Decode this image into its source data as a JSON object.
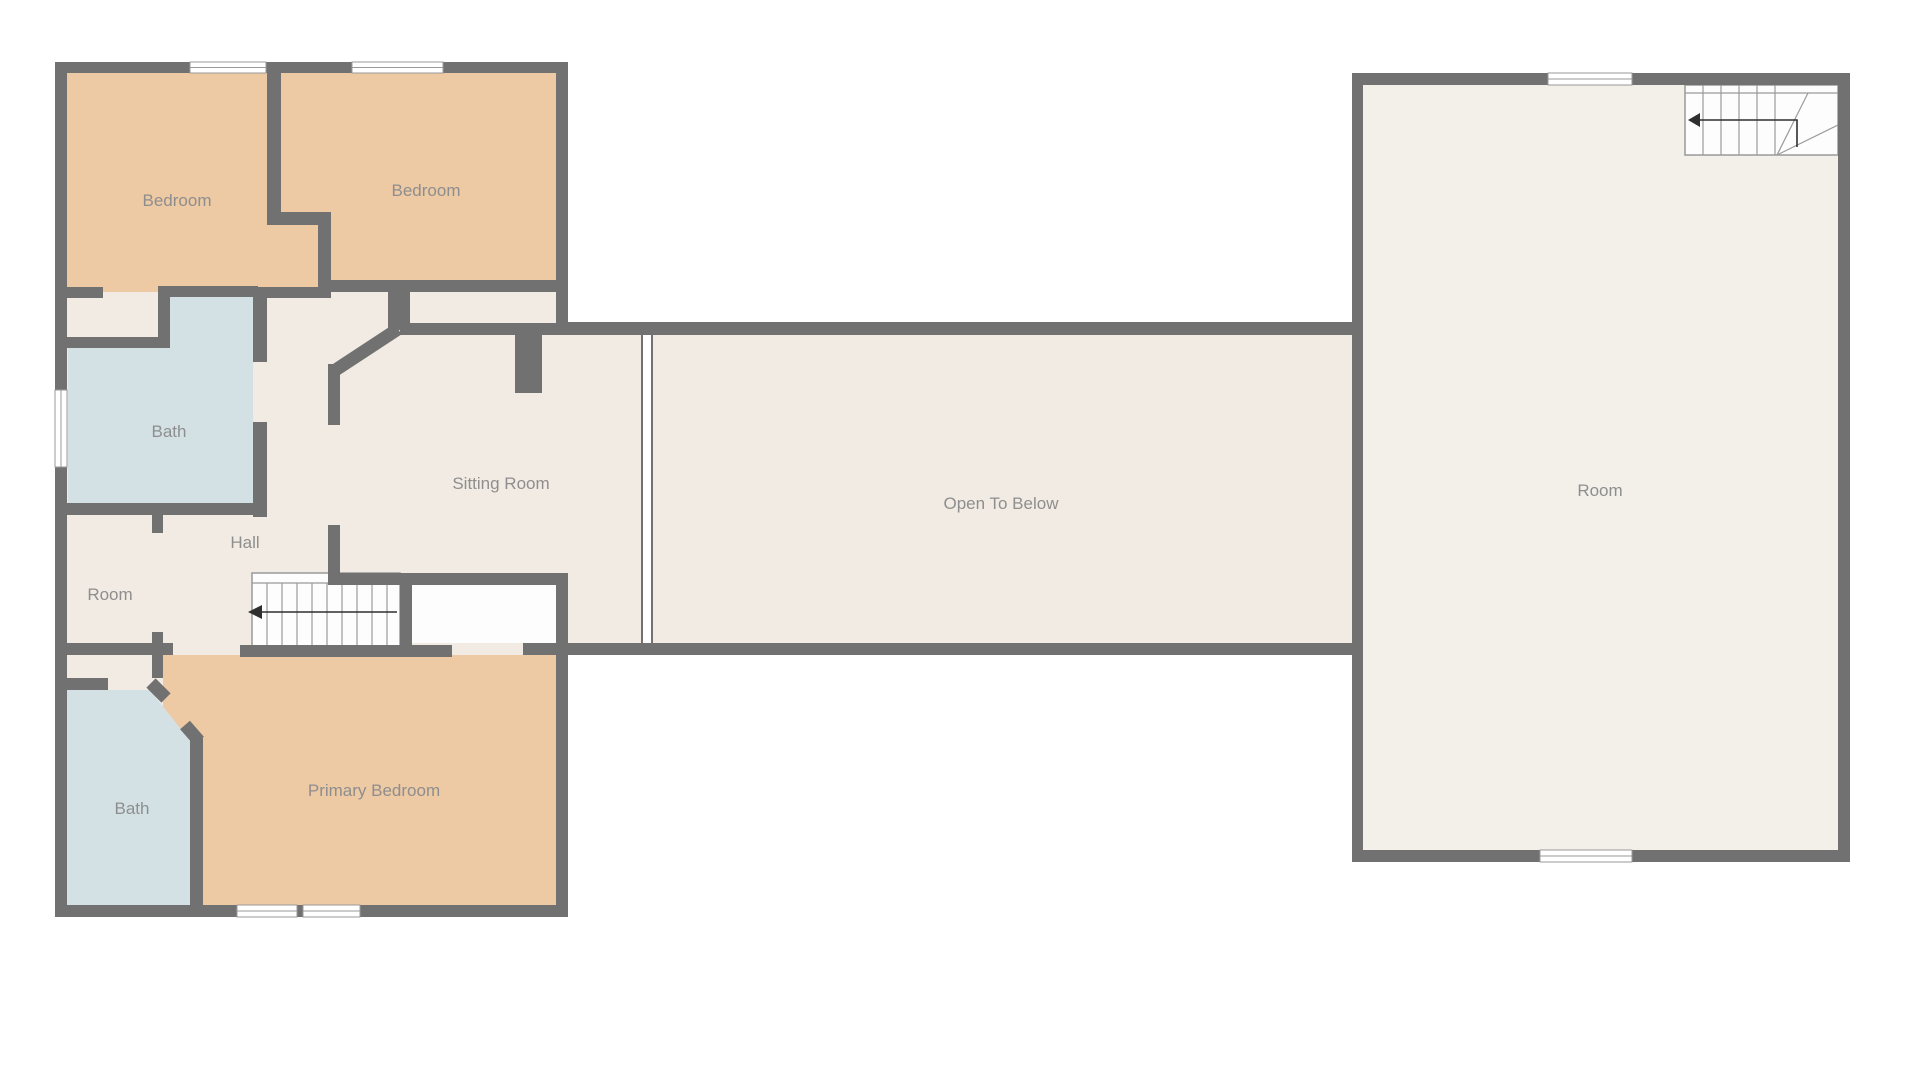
{
  "plan": {
    "type": "floor-plan",
    "floor_description": "Upper floor plan with two wings connected by an open-to-below gallery",
    "rooms": [
      {
        "id": "bedroom-1",
        "label": "Bedroom",
        "x": 177,
        "y": 200,
        "floor": "bedroom"
      },
      {
        "id": "bedroom-2",
        "label": "Bedroom",
        "x": 426,
        "y": 190,
        "floor": "bedroom"
      },
      {
        "id": "bath-upper",
        "label": "Bath",
        "x": 169,
        "y": 431,
        "floor": "bath"
      },
      {
        "id": "hall",
        "label": "Hall",
        "x": 245,
        "y": 542,
        "floor": "base"
      },
      {
        "id": "room-small",
        "label": "Room",
        "x": 110,
        "y": 594,
        "floor": "base"
      },
      {
        "id": "sitting-room",
        "label": "Sitting Room",
        "x": 501,
        "y": 483,
        "floor": "base"
      },
      {
        "id": "open-to-below",
        "label": "Open To Below",
        "x": 1001,
        "y": 503,
        "floor": "base"
      },
      {
        "id": "bath-lower",
        "label": "Bath",
        "x": 132,
        "y": 808,
        "floor": "bath"
      },
      {
        "id": "primary-bedroom",
        "label": "Primary Bedroom",
        "x": 374,
        "y": 790,
        "floor": "bedroom"
      },
      {
        "id": "room-right",
        "label": "Room",
        "x": 1600,
        "y": 490,
        "floor": "base"
      }
    ],
    "stairs": [
      {
        "id": "stairs-left",
        "direction": "down-to-left"
      },
      {
        "id": "stairs-right",
        "direction": "down-to-left-with-winder"
      }
    ],
    "windows_count": 7,
    "colors": {
      "wall": "#717171",
      "floor": "#f1ebe3",
      "floor_right": "#f3efe9",
      "bedroom": "#edc9a4",
      "bath": "#d3e1e5",
      "stairwell": "#fdfdfd",
      "thin": "#9a9a9a",
      "label": "#8e8e8e",
      "arrow": "#2f2f2f"
    }
  }
}
